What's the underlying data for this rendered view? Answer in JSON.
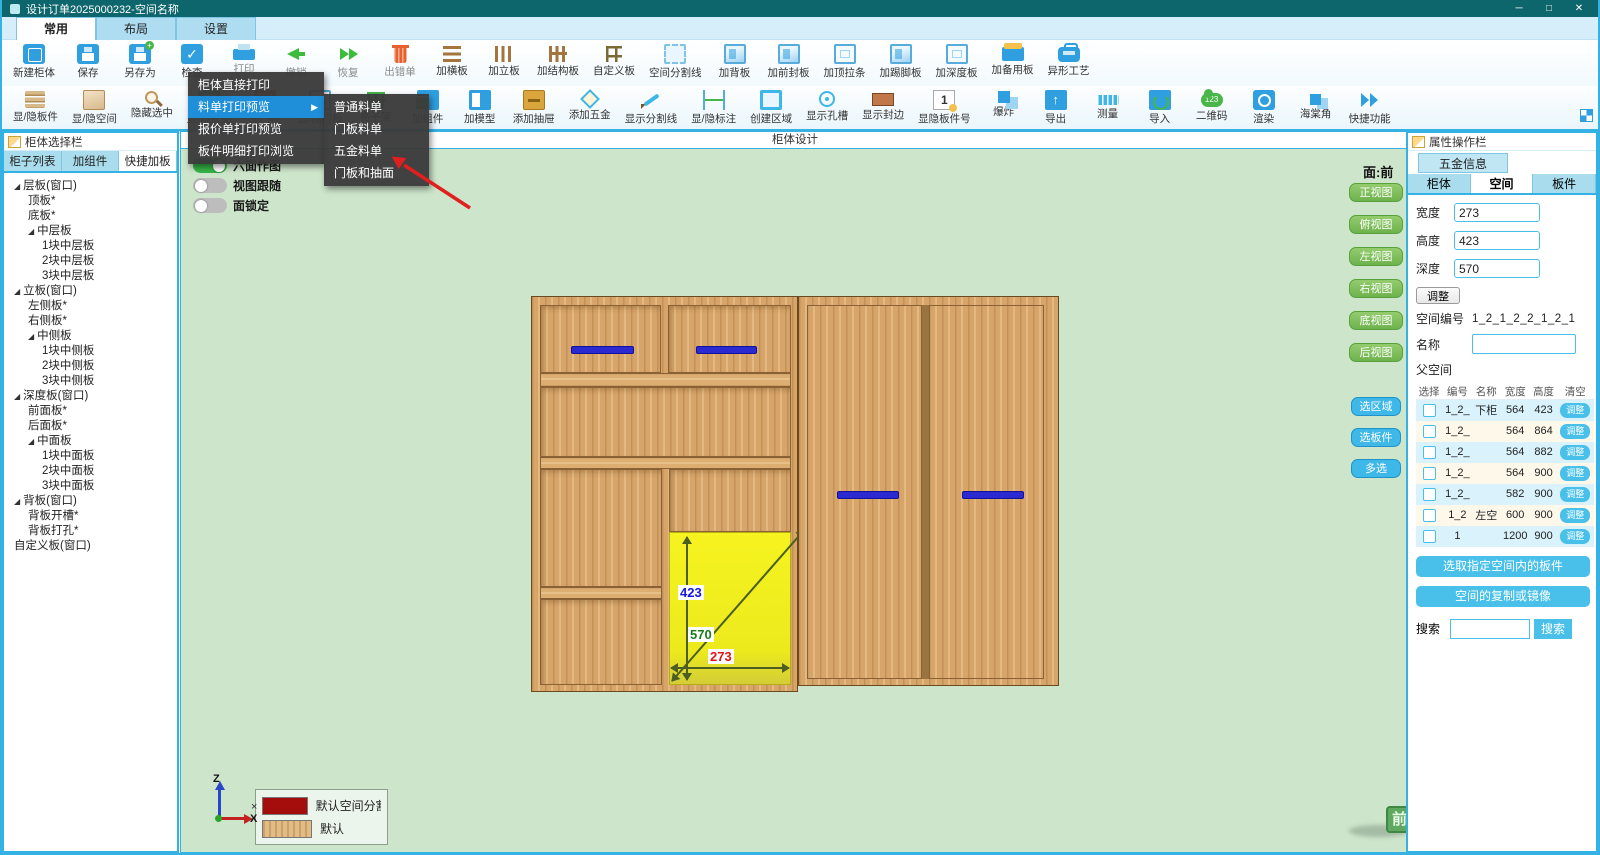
{
  "window": {
    "title": "设计订单2025000232-空间名称",
    "controls": [
      "─",
      "□",
      "✕"
    ]
  },
  "ribbon_tabs": [
    {
      "label": "常用",
      "active": true
    },
    {
      "label": "布局",
      "active": false
    },
    {
      "label": "设置",
      "active": false
    }
  ],
  "toolbar1": [
    {
      "label": "新建柜体",
      "icon": "cabinet-new"
    },
    {
      "label": "保存",
      "icon": "save"
    },
    {
      "label": "另存为",
      "icon": "save-as"
    },
    {
      "label": "检查",
      "icon": "check"
    },
    {
      "label": "打印",
      "icon": "print",
      "dim": true
    },
    {
      "label": "撤销",
      "icon": "undo",
      "dim": true
    },
    {
      "label": "恢复",
      "icon": "redo",
      "dim": true
    },
    {
      "label": "出错单",
      "icon": "trash",
      "dim": true
    },
    {
      "label": "加横板",
      "icon": "add-hboard"
    },
    {
      "label": "加立板",
      "icon": "add-vboard"
    },
    {
      "label": "加结构板",
      "icon": "add-structboard"
    },
    {
      "label": "自定义板",
      "icon": "custom-board"
    },
    {
      "label": "空间分割线",
      "icon": "space-splitline"
    },
    {
      "label": "加背板",
      "icon": "add-backboard"
    },
    {
      "label": "加前封板",
      "icon": "add-frontboard"
    },
    {
      "label": "加顶拉条",
      "icon": "add-topbar"
    },
    {
      "label": "加踢脚板",
      "icon": "add-kickboard"
    },
    {
      "label": "加深度板",
      "icon": "add-depthboard"
    },
    {
      "label": "加备用板",
      "icon": "add-spareboard"
    },
    {
      "label": "异形工艺",
      "icon": "shaped-craft"
    }
  ],
  "toolbar2": [
    {
      "label": "显/隐板件",
      "icon": "show-panels"
    },
    {
      "label": "显/隐空间",
      "icon": "show-space"
    },
    {
      "label": "隐藏选中",
      "icon": "hide-selected"
    },
    {
      "label": "显/隐孔面",
      "icon": "show-holes"
    },
    {
      "label": "加门板",
      "icon": "add-door"
    },
    {
      "label": "显/隐门板",
      "icon": "show-door"
    },
    {
      "label": "格子架",
      "icon": "lattice"
    },
    {
      "label": "加组件",
      "icon": "add-component"
    },
    {
      "label": "加模型",
      "icon": "add-model"
    },
    {
      "label": "添加抽屉",
      "icon": "add-drawer"
    },
    {
      "label": "添加五金",
      "icon": "add-hardware"
    },
    {
      "label": "显示分割线",
      "icon": "show-splitline"
    },
    {
      "label": "显/隐标注",
      "icon": "show-dimension"
    },
    {
      "label": "创建区域",
      "icon": "create-region"
    },
    {
      "label": "显示孔槽",
      "icon": "show-holeslot"
    },
    {
      "label": "显示封边",
      "icon": "show-edgeband"
    },
    {
      "label": "显隐板件号",
      "icon": "panel-number"
    },
    {
      "label": "爆炸",
      "icon": "explode"
    },
    {
      "label": "导出",
      "icon": "export"
    },
    {
      "label": "测量",
      "icon": "measure"
    },
    {
      "label": "导入",
      "icon": "import"
    },
    {
      "label": "二维码",
      "icon": "qrcode"
    },
    {
      "label": "渲染",
      "icon": "render"
    },
    {
      "label": "海棠角",
      "icon": "corner-cut"
    },
    {
      "label": "快捷功能",
      "icon": "quick-functions"
    }
  ],
  "context_menu": {
    "items": [
      "柜体直接打印",
      "料单打印预览",
      "报价单打印预览",
      "板件明细打印浏览"
    ],
    "highlight_index": 1,
    "submenu": [
      "普通料单",
      "门板料单",
      "五金料单",
      "门板和抽面"
    ]
  },
  "toggles": [
    {
      "label": "六面作图",
      "on": true
    },
    {
      "label": "视图跟随",
      "on": false
    },
    {
      "label": "面锁定",
      "on": false
    }
  ],
  "left_panel": {
    "header": "柜体选择栏",
    "tabs": [
      {
        "label": "柜子列表",
        "active": false
      },
      {
        "label": "加组件",
        "active": false
      },
      {
        "label": "快捷加板",
        "active": true
      }
    ],
    "tree": [
      {
        "label": "层板(窗口)",
        "level": 0,
        "expand": true
      },
      {
        "label": "顶板*",
        "level": 1
      },
      {
        "label": "底板*",
        "level": 1
      },
      {
        "label": "中层板",
        "level": 1,
        "expand": true
      },
      {
        "label": "1块中层板",
        "level": 2
      },
      {
        "label": "2块中层板",
        "level": 2
      },
      {
        "label": "3块中层板",
        "level": 2
      },
      {
        "label": "立板(窗口)",
        "level": 0,
        "expand": true
      },
      {
        "label": "左侧板*",
        "level": 1
      },
      {
        "label": "右侧板*",
        "level": 1
      },
      {
        "label": "中侧板",
        "level": 1,
        "expand": true
      },
      {
        "label": "1块中侧板",
        "level": 2
      },
      {
        "label": "2块中侧板",
        "level": 2
      },
      {
        "label": "3块中侧板",
        "level": 2
      },
      {
        "label": "深度板(窗口)",
        "level": 0,
        "expand": true
      },
      {
        "label": "前面板*",
        "level": 1
      },
      {
        "label": "后面板*",
        "level": 1
      },
      {
        "label": "中面板",
        "level": 1,
        "expand": true
      },
      {
        "label": "1块中面板",
        "level": 2
      },
      {
        "label": "2块中面板",
        "level": 2
      },
      {
        "label": "3块中面板",
        "level": 2
      },
      {
        "label": "背板(窗口)",
        "level": 0,
        "expand": true
      },
      {
        "label": "背板开槽*",
        "level": 1
      },
      {
        "label": "背板打孔*",
        "level": 1
      },
      {
        "label": "自定义板(窗口)",
        "level": 0
      }
    ]
  },
  "canvas": {
    "title": "柜体设计",
    "face_label": "面:前",
    "view_buttons": [
      "正视图",
      "俯视图",
      "左视图",
      "右视图",
      "底视图",
      "后视图"
    ],
    "select_buttons": [
      "选区域",
      "选板件",
      "多选"
    ],
    "dims": {
      "height": "423",
      "depth": "570",
      "width": "273"
    },
    "legend": [
      {
        "label": "默认空间分割",
        "type": "red"
      },
      {
        "label": "默认",
        "type": "wood"
      }
    ],
    "axes": {
      "z": "Z",
      "x": "X",
      "cursor": "×"
    },
    "front_badge": "前"
  },
  "right_panel": {
    "header": "属性操作栏",
    "info_tab": "五金信息",
    "tabs": [
      {
        "label": "柜体",
        "active": false
      },
      {
        "label": "空间",
        "active": true
      },
      {
        "label": "板件",
        "active": false
      }
    ],
    "fields": [
      {
        "label": "宽度",
        "value": "273"
      },
      {
        "label": "高度",
        "value": "423"
      },
      {
        "label": "深度",
        "value": "570"
      }
    ],
    "adjust_button": "调整",
    "space_no_label": "空间编号",
    "space_no": "1_2_1_2_2_1_2_1",
    "name_label": "名称",
    "name_value": "",
    "parent_label": "父空间",
    "table": {
      "headers": [
        "选择",
        "编号",
        "名称",
        "宽度",
        "高度",
        "清空"
      ],
      "row_button": "调整",
      "rows": [
        {
          "no": "1_2_",
          "name": "下柜",
          "w": "564",
          "h": "423"
        },
        {
          "no": "1_2_",
          "name": "",
          "w": "564",
          "h": "864"
        },
        {
          "no": "1_2_",
          "name": "",
          "w": "564",
          "h": "882"
        },
        {
          "no": "1_2_",
          "name": "",
          "w": "564",
          "h": "900"
        },
        {
          "no": "1_2_",
          "name": "",
          "w": "582",
          "h": "900"
        },
        {
          "no": "1_2",
          "name": "左空",
          "w": "600",
          "h": "900"
        },
        {
          "no": "1",
          "name": "",
          "w": "1200",
          "h": "900"
        }
      ]
    },
    "action_buttons": [
      "选取指定空间内的板件",
      "空间的复制或镜像"
    ],
    "search_label": "搜索",
    "search_button": "搜索"
  }
}
